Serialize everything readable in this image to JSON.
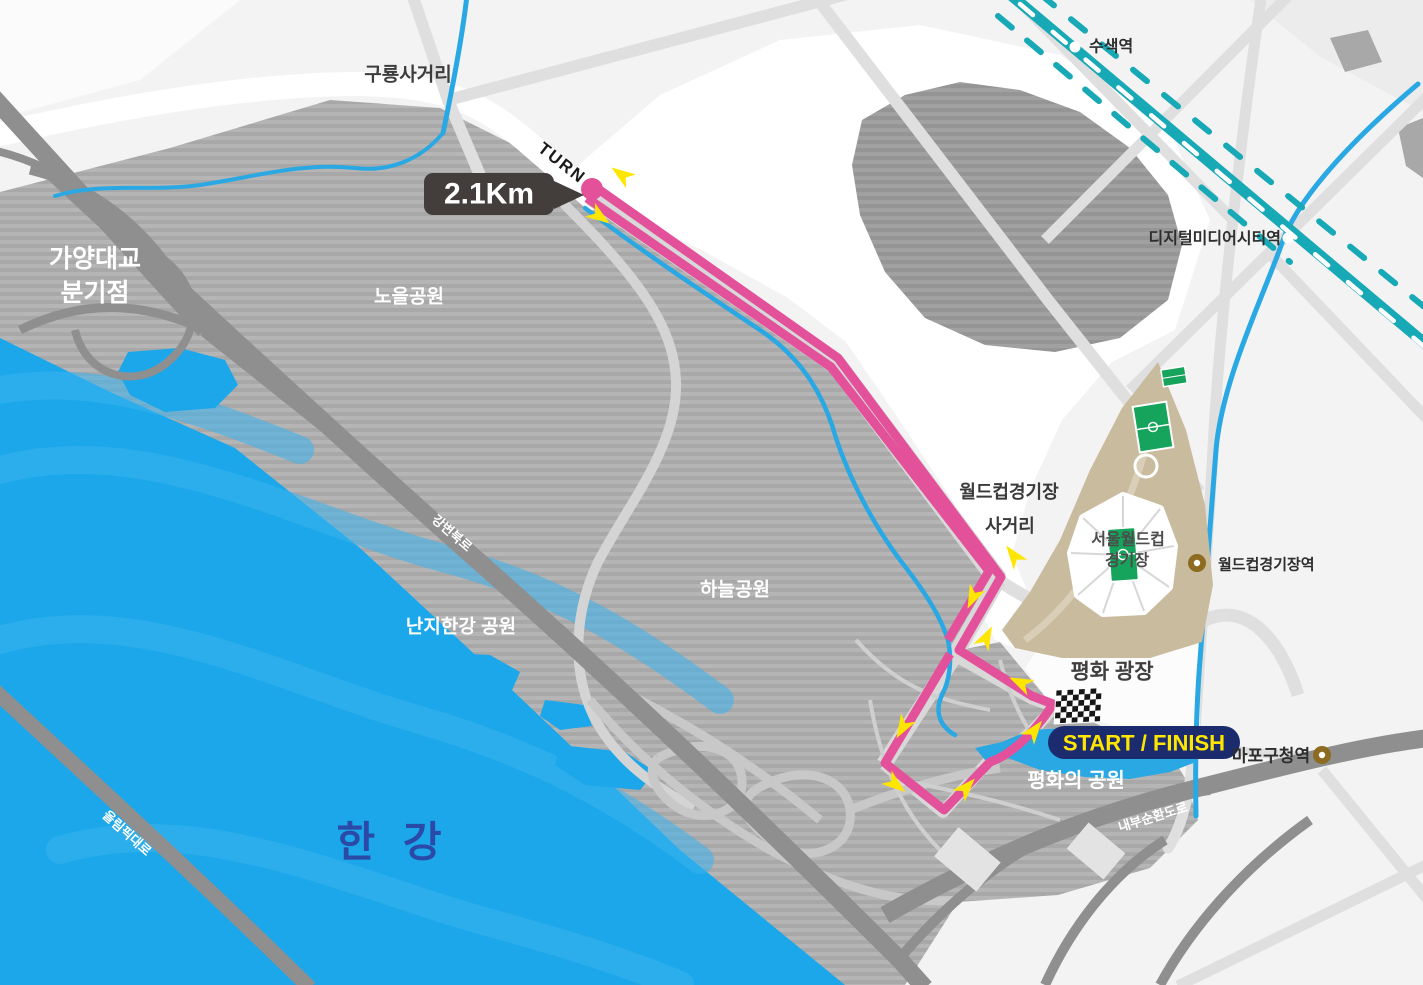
{
  "map_title": "Seoul World Cup Park 2.1Km course map",
  "course": {
    "distance_marker": "2.1Km",
    "turn_label": "TURN",
    "start_finish_label": "START / FINISH",
    "route_color": "#E2519A",
    "arrow_color": "#FFE600",
    "start_finish_badge_color": "#1C2B6E",
    "distance_badge_color": "#433D3C"
  },
  "labels": {
    "guryong": "구룡사거리",
    "turn": "TURN",
    "turn_km": "2.1Km",
    "gayang1": "가양대교",
    "gayang2": "분기점",
    "noeul": "노을공원",
    "haneul": "하늘공원",
    "nanji": "난지한강 공원",
    "gangbyeon": "강변북로",
    "olympic": "올림픽대로",
    "han_river": "한 강",
    "susaek": "수색역",
    "dmc": "디지털미디어시티역",
    "wc_cross1": "월드컵경기장",
    "wc_cross2": "사거리",
    "stadium1": "서울월드컵",
    "stadium2": "경기장",
    "wc_station": "월드컵경기장역",
    "peace_plaza": "평화 광장",
    "start_finish": "START / FINISH",
    "peace_park": "평화의 공원",
    "mapo": "마포구청역",
    "naebu": "내부순환도로"
  },
  "stations": [
    {
      "name": "수색역",
      "marker": "white-dot"
    },
    {
      "name": "디지털미디어시티역",
      "marker": "white-dot"
    },
    {
      "name": "월드컵경기장역",
      "marker": "gold-dot"
    },
    {
      "name": "마포구청역",
      "marker": "gold-dot"
    }
  ],
  "colors": {
    "river": "#1BA7EA",
    "river_wave": "#3AB3EF",
    "stream": "#2AA8E3",
    "railway": "#17A9B6",
    "park_stripe_light": "#B5B5B5",
    "park_stripe_dark": "#A8A8A8",
    "island_stripe_light": "#A1A1A1",
    "island_stripe_dark": "#959595",
    "road_dark": "#8F8F8F",
    "road_light": "#DFDFDF",
    "stadium_ground": "#C9BB9E",
    "field_green": "#16A35B",
    "station_gold": "#8D6B20",
    "han_river_text": "#2B49A7",
    "label_dark": "#3A3A3A",
    "label_white": "#FFFFFF"
  }
}
